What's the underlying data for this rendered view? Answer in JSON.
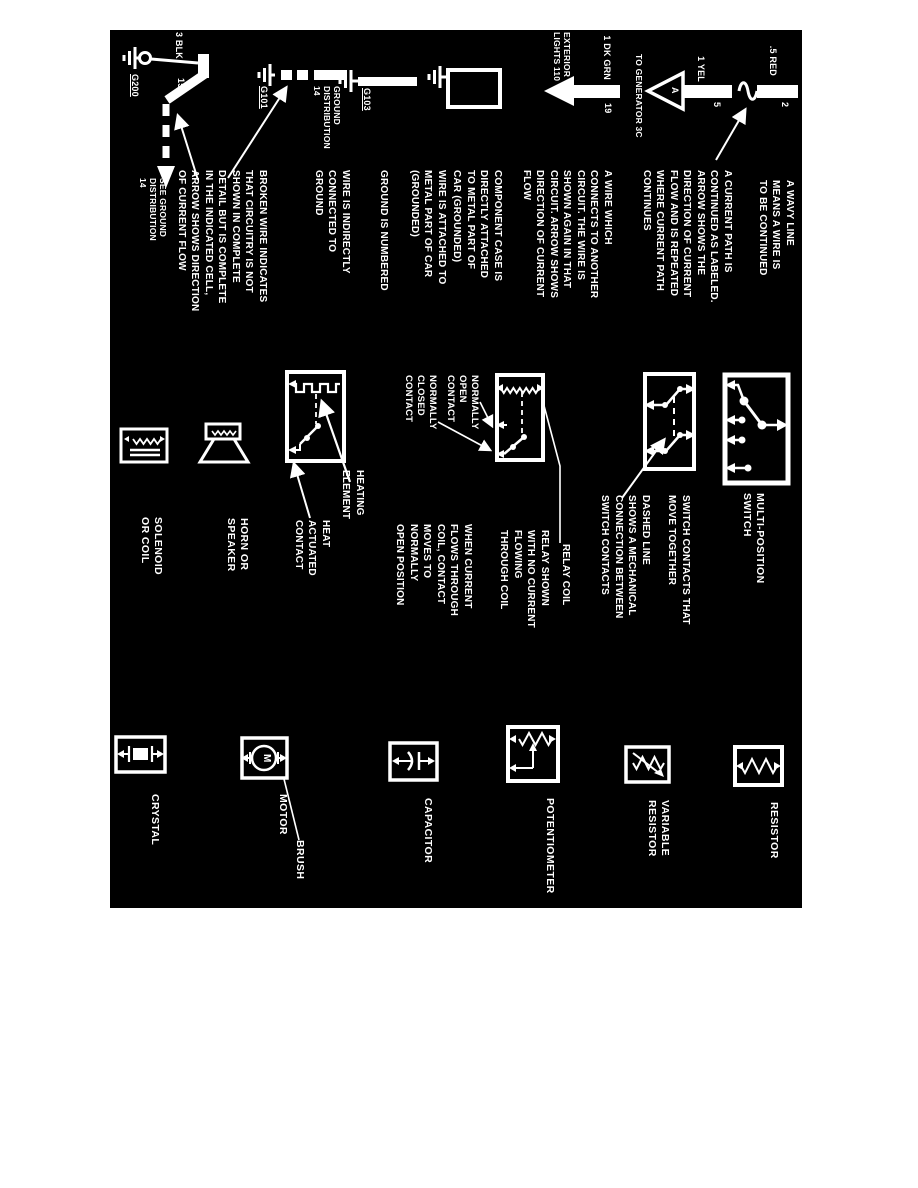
{
  "colors": {
    "paper": "#ffffff",
    "panel": "#000000",
    "ink": "#ffffff"
  },
  "wires": {
    "wavy": {
      "gauge": ".5 RED",
      "circuit": "2",
      "caption": [
        "A WAVY LINE",
        "MEANS A WIRE IS",
        "TO BE CONTINUED"
      ]
    },
    "current_path": {
      "gauge": "1 YEL",
      "circuit": "5",
      "connector_letter": "A",
      "destination": "TO GENERATOR 3C",
      "caption": [
        "A CURRENT PATH IS",
        "CONTINUED AS LABELED.",
        "ARROW SHOWS THE",
        "DIRECTION OF CURRENT",
        "FLOW AND IS REPEATED",
        "WHERE CURRENT PATH",
        "CONTINUES"
      ]
    },
    "wire_to_circuit": {
      "gauge": "1 DK GRN",
      "circuit": "19",
      "destination": [
        "EXTERIOR",
        "LIGHTS 110"
      ],
      "caption": [
        "A WIRE WHICH",
        "CONNECTS TO ANOTHER",
        "CIRCUIT. THE WIRE IS",
        "SHOWN AGAIN IN THAT",
        "CIRCUIT. ARROW SHOWS",
        "DIRECTION OF CURRENT",
        "FLOW"
      ]
    },
    "component_case": {
      "caption": [
        "COMPONENT CASE IS",
        "DIRECTLY ATTACHED",
        "TO METAL PART OF",
        "CAR (GROUNDED)"
      ]
    },
    "grounded_wire": {
      "ground_id": "G103",
      "caption": [
        "WIRE IS ATTACHED TO",
        "METAL PART OF CAR",
        "(GROUNDED)"
      ],
      "note": "GROUND IS NUMBERED"
    },
    "indirect_ground": {
      "ground_id": "G101",
      "label": [
        "GROUND",
        "DISTRIBUTION",
        "14"
      ],
      "caption": [
        "WIRE IS INDIRECTLY",
        "CONNECTED TO",
        "GROUND"
      ]
    },
    "broken_wire": {
      "gauge": "3 BLK",
      "circuit": "150",
      "ground_id": "G200",
      "label": [
        "SEE GROUND",
        "DISTRIBUTION",
        "14"
      ],
      "caption": [
        "BROKEN WIRE INDICATES",
        "THAT CIRCUITRY IS NOT",
        "SHOWN IN COMPLETE",
        "DETAIL BUT IS COMPLETE",
        "IN THE INDICATED CELL,",
        "ARROW SHOWS DIRECTION",
        "OF CURRENT FLOW"
      ]
    }
  },
  "switches": {
    "multi_position": {
      "label": [
        "MULTI-POSITION",
        "SWITCH"
      ]
    },
    "contacts": {
      "caption_move": [
        "SWITCH CONTACTS THAT",
        "MOVE TOGETHER"
      ],
      "caption_dashed": [
        "DASHED LINE",
        "SHOWS A MECHANICAL",
        "CONNECTION BETWEEN",
        "SWITCH CONTACTS"
      ]
    },
    "relay": {
      "label_coil": "RELAY COIL",
      "caption_state": [
        "RELAY SHOWN",
        "WITH NO CURRENT",
        "FLOWING",
        "THROUGH COIL"
      ],
      "label_no": [
        "NORMALLY",
        "OPEN",
        "CONTACT"
      ],
      "label_nc": [
        "NORMALLY",
        "CLOSED",
        "CONTACT"
      ],
      "caption_action": [
        "WHEN CURRENT",
        "FLOWS THROUGH",
        "COIL, CONTACT",
        "MOVES TO",
        "NORMALLY",
        "OPEN POSITION"
      ]
    },
    "heating": {
      "label_element": [
        "HEATING",
        "ELEMENT"
      ],
      "label_contact": [
        "HEAT",
        "ACTUATED",
        "CONTACT"
      ]
    }
  },
  "components": {
    "horn": [
      "HORN OR",
      "SPEAKER"
    ],
    "solenoid": [
      "SOLENOID",
      "OR COIL"
    ],
    "resistor": "RESISTOR",
    "variable_resistor": [
      "VARIABLE",
      "RESISTOR"
    ],
    "potentiometer": "POTENTIOMETER",
    "capacitor": "CAPACITOR",
    "motor": "MOTOR",
    "motor_letter": "M",
    "brush": "BRUSH",
    "crystal": "CRYSTAL"
  }
}
